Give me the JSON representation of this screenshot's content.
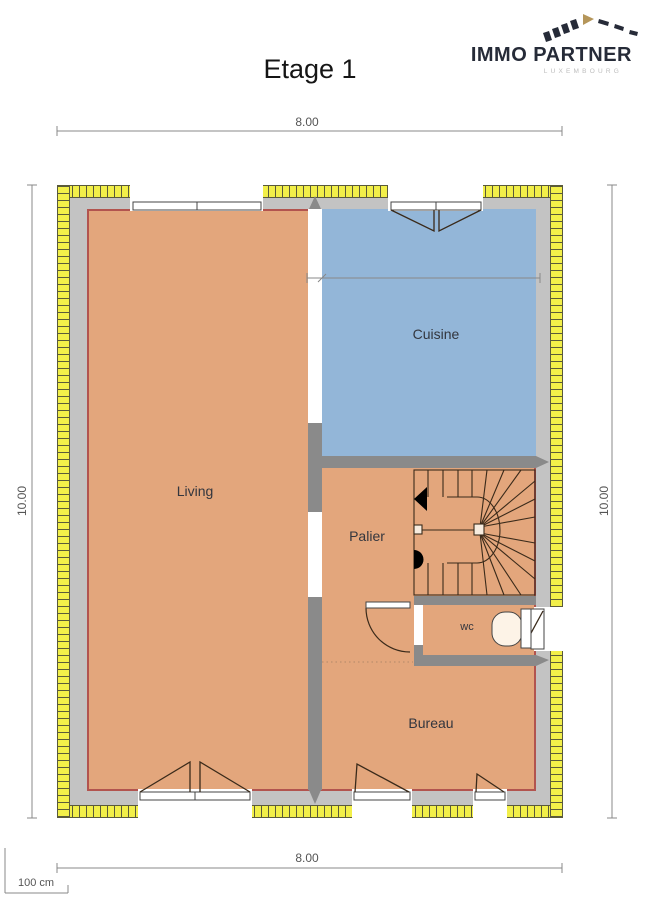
{
  "title": "Etage 1",
  "logo": {
    "name": "IMMO PARTNER",
    "subtitle": "LUXEMBOURG"
  },
  "dimensions": {
    "top": "8.00",
    "bottom": "8.00",
    "left": "10.00",
    "right": "10.00",
    "kitchen_width": "3.41",
    "wall_thickness": "22"
  },
  "scale_bar": {
    "label": "100 cm"
  },
  "rooms": {
    "living": {
      "label": "Living"
    },
    "cuisine": {
      "label": "Cuisine"
    },
    "palier": {
      "label": "Palier"
    },
    "wc": {
      "label": "wc"
    },
    "bureau": {
      "label": "Bureau"
    }
  },
  "colors": {
    "floor": "#e3a67c",
    "kitchen": "#93b6d8",
    "wall-exterior": "#c3c3c3",
    "wall-interior": "#8a8a8a",
    "brick": "#f2ef49",
    "inner-outline": "#b2544f",
    "linework": "#3a2a1a",
    "dim-line": "#888888",
    "dim-text": "#555555",
    "label": "#33363e",
    "logo-navy": "#262b38",
    "logo-gold": "#b5965a"
  }
}
